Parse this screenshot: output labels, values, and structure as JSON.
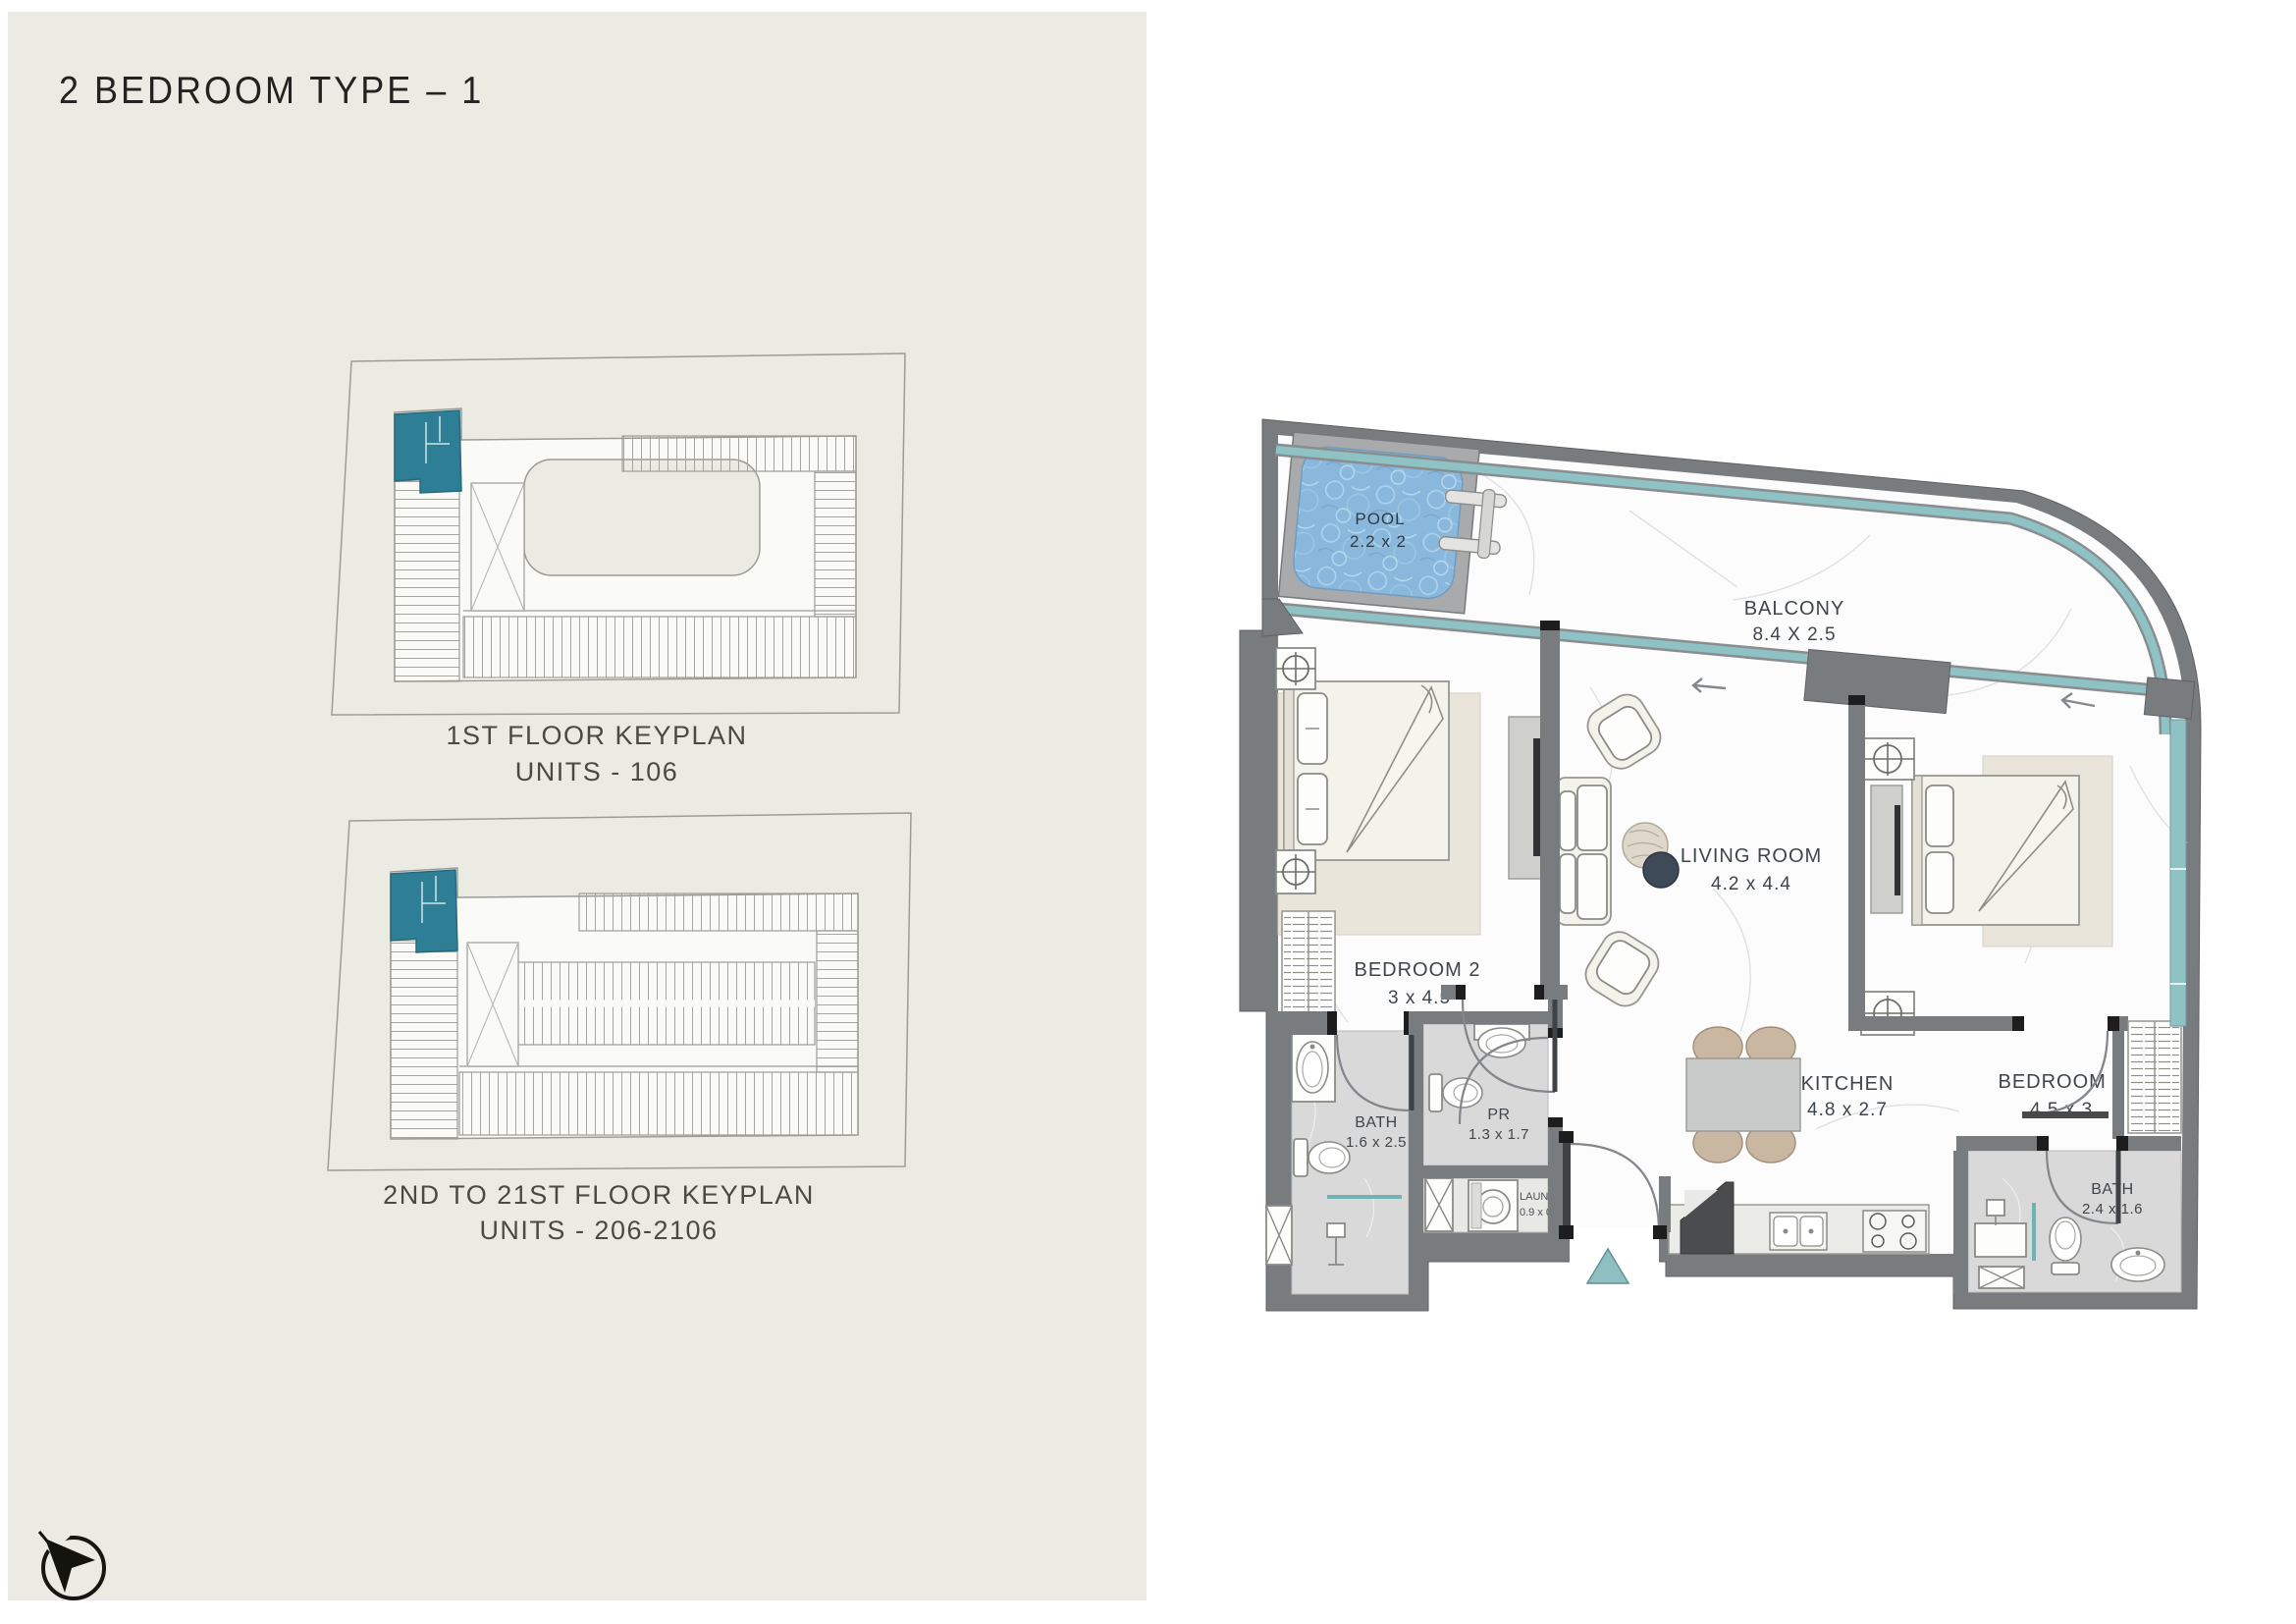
{
  "header": {
    "title": "2 BEDROOM TYPE – 1"
  },
  "keyplans": [
    {
      "caption_line1": "1ST FLOOR KEYPLAN",
      "caption_line2": "UNITS - 106"
    },
    {
      "caption_line1": "2ND TO 21ST FLOOR KEYPLAN",
      "caption_line2": "UNITS - 206-2106"
    }
  ],
  "floorplan": {
    "rooms": {
      "pool": {
        "name": "POOL",
        "dims": "2.2 x 2"
      },
      "balcony": {
        "name": "BALCONY",
        "dims": "8.4 X 2.5"
      },
      "bedroom2": {
        "name": "BEDROOM 2",
        "dims": "3 x  4.5"
      },
      "living": {
        "name": "LIVING ROOM",
        "dims": "4.2 x  4.4"
      },
      "bedroom1": {
        "name": "BEDROOM 1",
        "dims": "4.5 x  3"
      },
      "kitchen": {
        "name": "KITCHEN",
        "dims": "4.8 x  2.7"
      },
      "bath1": {
        "name": "BATH",
        "dims": "1.6 x 2.5"
      },
      "pr": {
        "name": "PR",
        "dims": "1.3 x 1.7"
      },
      "laundry": {
        "name": "LAUNDRY",
        "dims": "0.9 x 0.7"
      },
      "bath2": {
        "name": "BATH",
        "dims": "2.4 x 1.6"
      }
    },
    "colors": {
      "panel_beige": "#ecebe3",
      "highlight_unit_teal": "#2e7f95",
      "glass_teal": "#8fc2c4",
      "entrance_marker_teal": "#8fbfc1",
      "wall_gray": "#797c7e",
      "pool_water_blue": "#8ab8dc",
      "label_ink": "#3e454b"
    }
  }
}
